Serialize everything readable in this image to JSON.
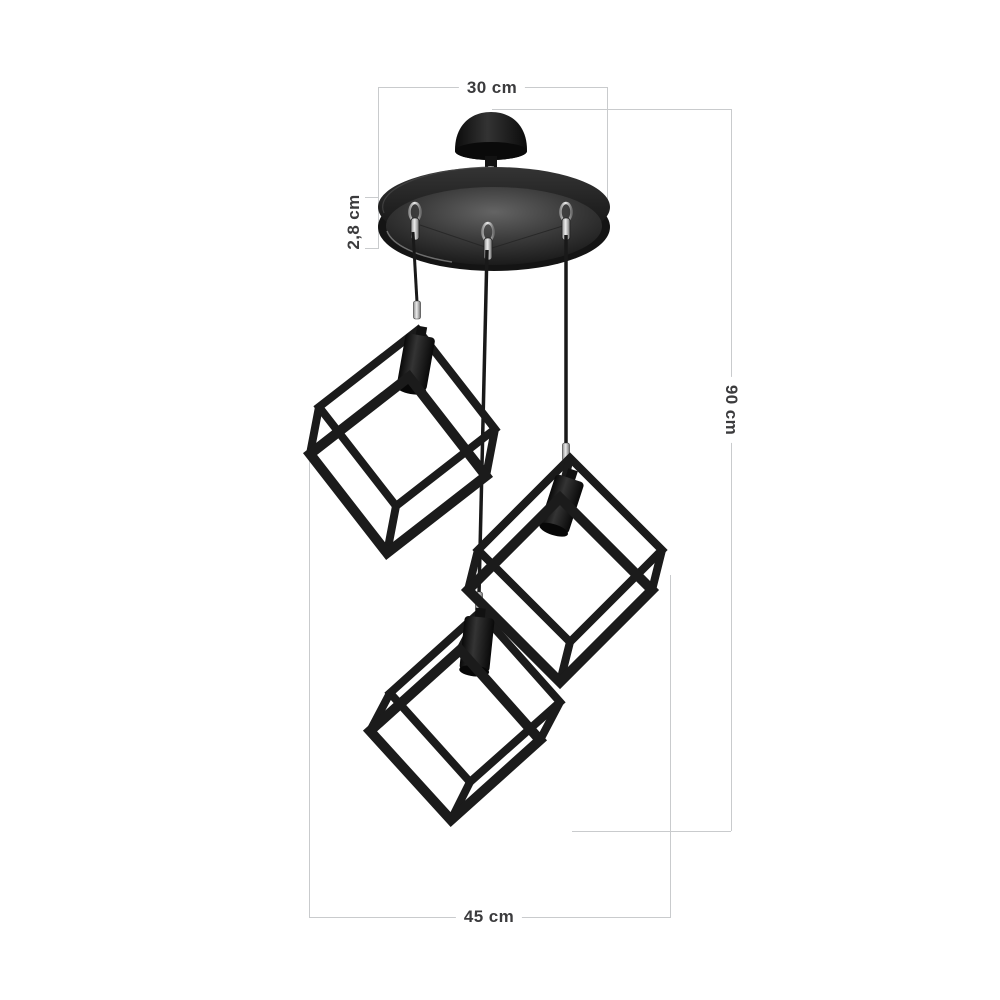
{
  "diagram": {
    "subject": "3-light cube cage pendant chandelier with round ceiling plate",
    "background": "#ffffff",
    "dimension_line_color": "#c9cbcd",
    "label_color": "#3b3b3d",
    "fixture_color": "#161616",
    "dimensions": {
      "plate_diameter": "30 cm",
      "plate_thickness": "2,8 cm",
      "hanging_height": "90 cm",
      "overall_width": "45 cm"
    }
  }
}
